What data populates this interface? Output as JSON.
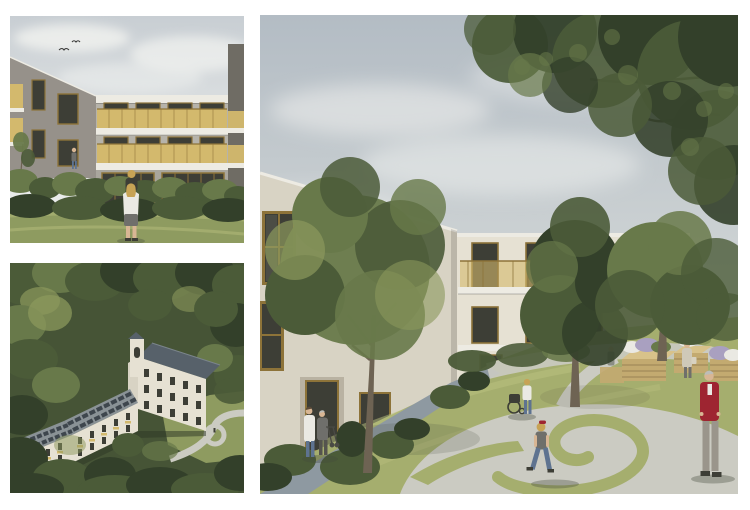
{
  "page": {
    "background": "#ffffff",
    "kind": "architectural-rendering-collage"
  },
  "gallery": {
    "layout": "two-stacked-left, one-large-right",
    "images": [
      {
        "name": "garden-facade-view",
        "alt": "Eye-level rendering of a three-storey residential building with grey facade, gold-yellow balcony parapets and a glazed ground floor behind shrubs and a meadow; a woman carries a child on her shoulders; two birds fly in a pale cloudy sky"
      },
      {
        "name": "aerial-forest-view",
        "alt": "Aerial rendering of a white care-home complex in dense woodland: a curved wing with rooftop solar panels joins a taller gabled building with a dark pitched roof and a small tower; a driveway loop sits in a clearing at lower right"
      },
      {
        "name": "courtyard-view",
        "alt": "Courtyard rendering: an L-shaped cream building with gold-framed windows and glazed balconies encloses a green courtyard with large trees, a spiral lawn in a paved plaza, raised wooden planting beds, a caregiver with an elderly man and rollator, a wheelchair, a walking child and an elderly man in a red cardigan beneath an overhanging tree canopy"
      }
    ]
  },
  "palette": {
    "pageBg": "#ffffff",
    "sky1": "#ccd2d6",
    "sky2": "#b6bfc7",
    "cloud": "#f0f1ef",
    "wallShade": "#96918a",
    "wallMid": "#a9a69d",
    "wallLight": "#b6b3aa",
    "wallDark": "#6f6c64",
    "cream1": "#e6e1d3",
    "cream2": "#d8d3c4",
    "slab": "#edebe3",
    "gold": "#d3b96d",
    "frame": "#8d7339",
    "glass": "#3d3e36",
    "leaf1": "#33402a",
    "leaf2": "#4b5b38",
    "leaf3": "#68794a",
    "leaf4": "#8b985c",
    "grass": "#a5ae6e",
    "grassL": "#bcc180",
    "meadow": "#8e9b60",
    "forest": "#465436",
    "pathL": "#cbcbc2",
    "pathB": "#8e99a1",
    "roof": "#8a9296",
    "roofD": "#57616a",
    "solar": "#3e464d",
    "wood": "#c3aa70",
    "woodL": "#d8c28a",
    "metal": "#9aa1a3",
    "stone": "#b9b2a2",
    "red": "#9e2531",
    "denim": "#5e7390",
    "skin": "#d8b694",
    "blond": "#c7a355",
    "greyC": "#6f6f6b",
    "whiteC": "#eae9e3",
    "trouser": "#9a958b",
    "hairG": "#bdbdb8",
    "beige": "#cfc9b8",
    "trunk": "#6e6353",
    "branch": "#3a3528",
    "shadow": "rgba(70,75,60,0.35)"
  }
}
